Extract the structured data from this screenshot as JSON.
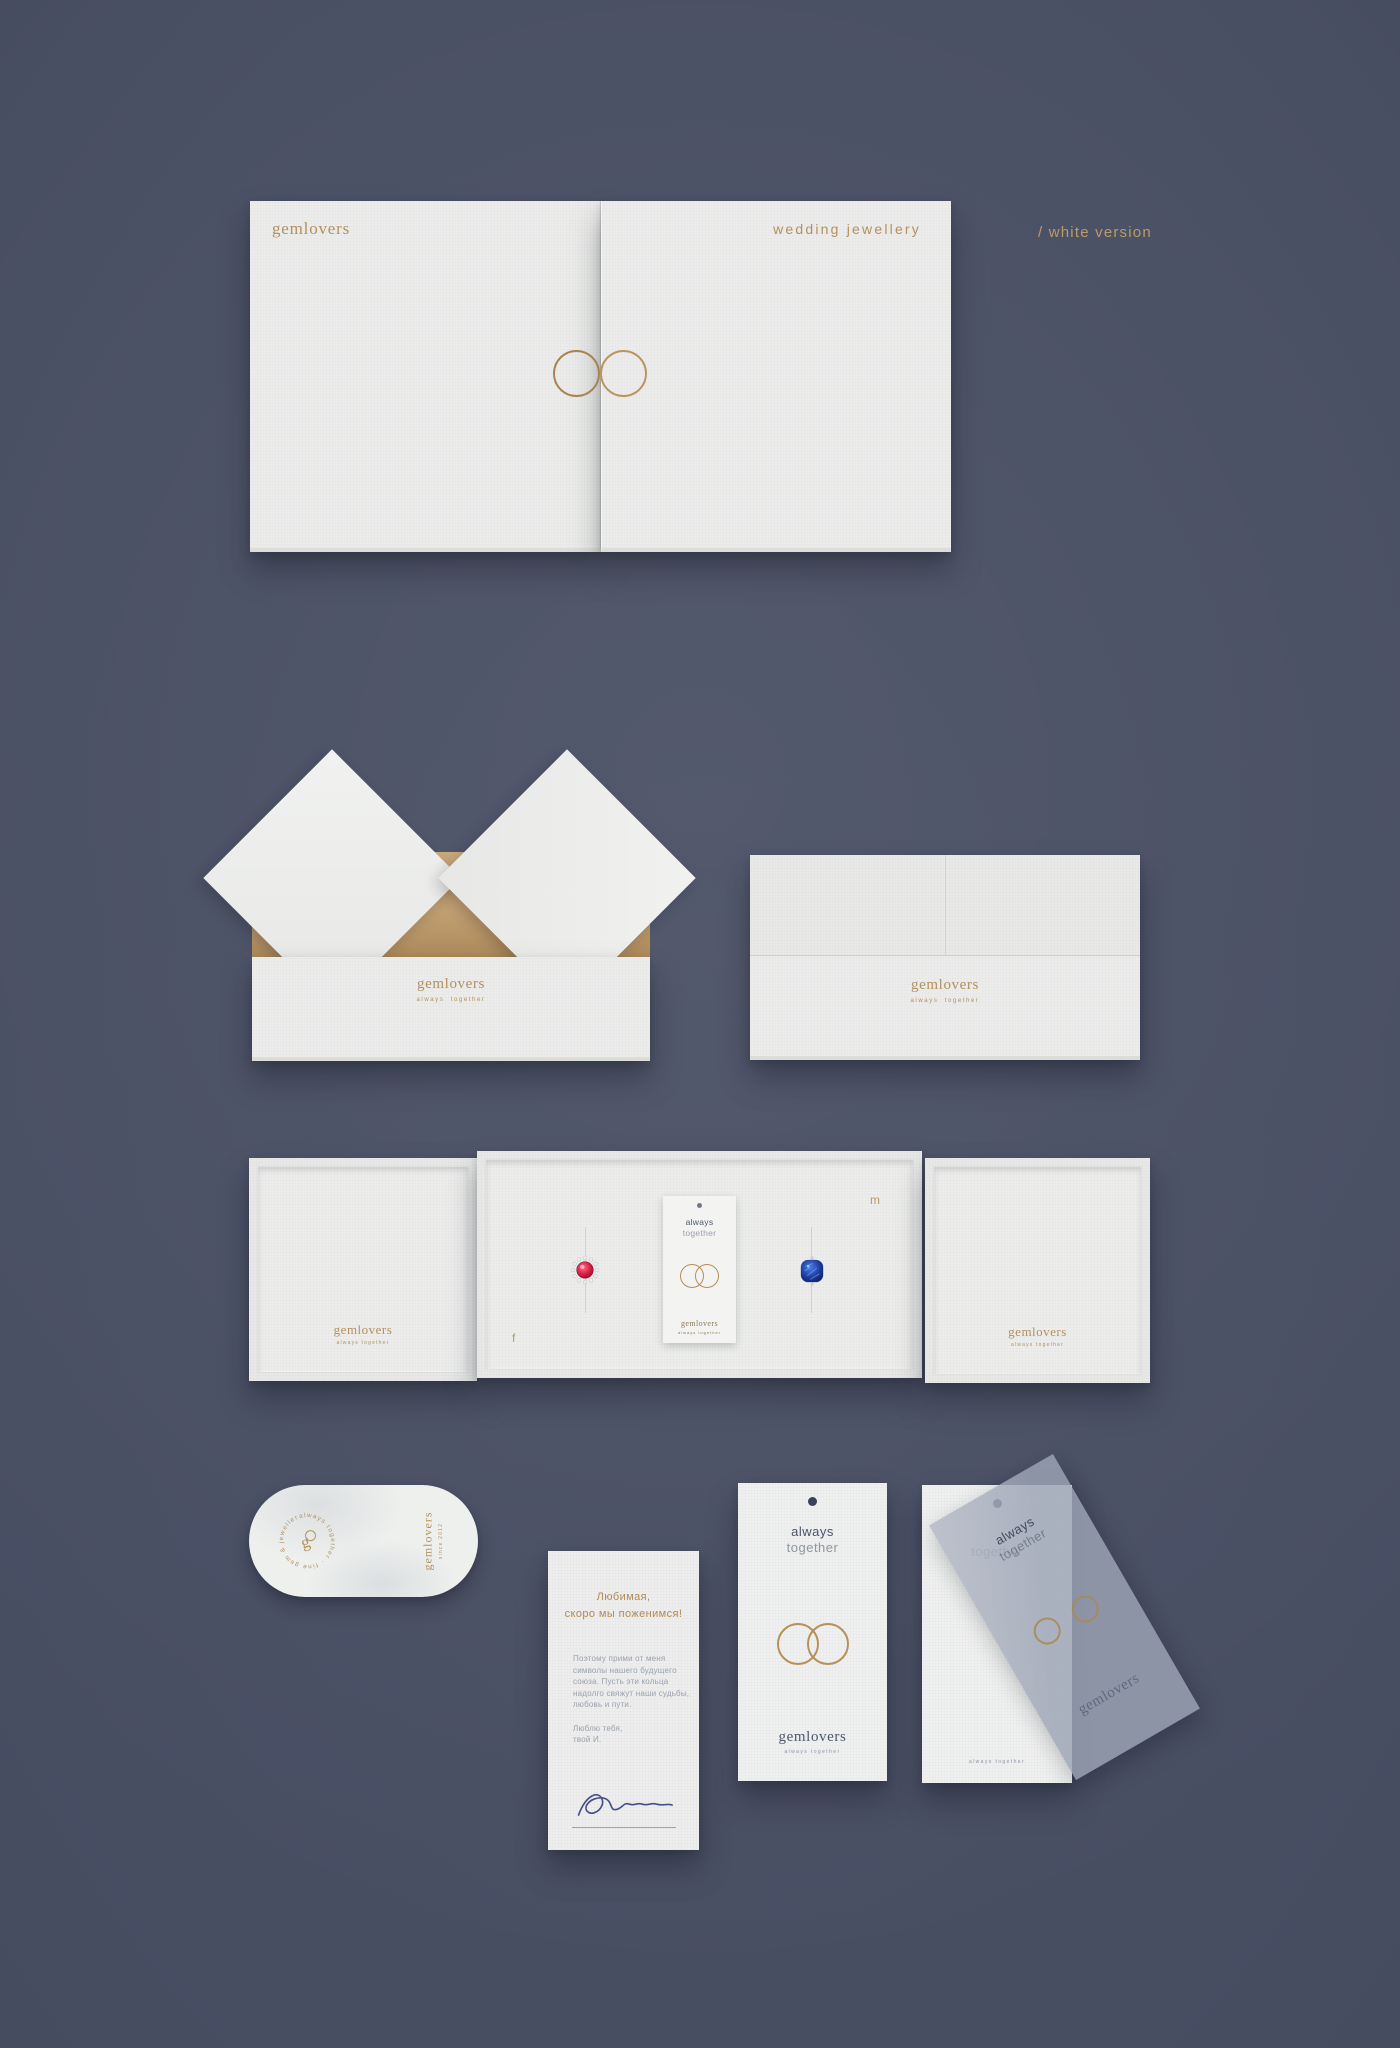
{
  "annotation": "/ white version",
  "row1": {
    "brand": "gemlovers",
    "product": "wedding jewellery"
  },
  "row2": {
    "open_box": {
      "brand": "gemlovers",
      "tagline": "always together"
    },
    "closed_box": {
      "brand": "gemlovers",
      "tagline": "always together"
    }
  },
  "row3": {
    "left_panel": {
      "brand": "gemlovers",
      "tagline": "always together"
    },
    "right_panel": {
      "brand": "gemlovers",
      "tagline": "always together"
    },
    "tray": {
      "marker_f": "f",
      "marker_m": "m",
      "card": {
        "line1": "always",
        "line2": "together",
        "brand": "gemlovers",
        "tagline": "always together"
      }
    }
  },
  "row4": {
    "sticker": {
      "circular_text": "always together · fine gem & jewellery ·",
      "monogram": "g",
      "brand_vertical": "gemlovers",
      "since": "since 2012"
    },
    "letter": {
      "heading1": "Любимая,",
      "heading2": "скоро мы поженимся!",
      "body": [
        "Поэтому прими от меня",
        "символы нашего будущего",
        "союза. Пусть эти кольца",
        "надолго свяжут наши судьбы,",
        "любовь и пути."
      ],
      "closing1": "Люблю тебя,",
      "closing2": "твой И."
    },
    "tag1": {
      "line1": "always",
      "line2": "together",
      "brand": "gemlovers",
      "tagline": "always together"
    },
    "tag2": {
      "line2": "together",
      "tagline": "always together"
    },
    "vellum": {
      "line1": "always",
      "line2": "together",
      "brand": "gemlovers"
    }
  },
  "colors": {
    "background": "#484e62",
    "gold": "#b3905e",
    "box_white": "#ecedeb",
    "kraft": "#c2a072",
    "navy_text": "#4b5569",
    "gray_text": "#8f97a7",
    "ruby": "#c21d3f",
    "sapphire": "#16368f",
    "signature_ink": "#35447f"
  }
}
